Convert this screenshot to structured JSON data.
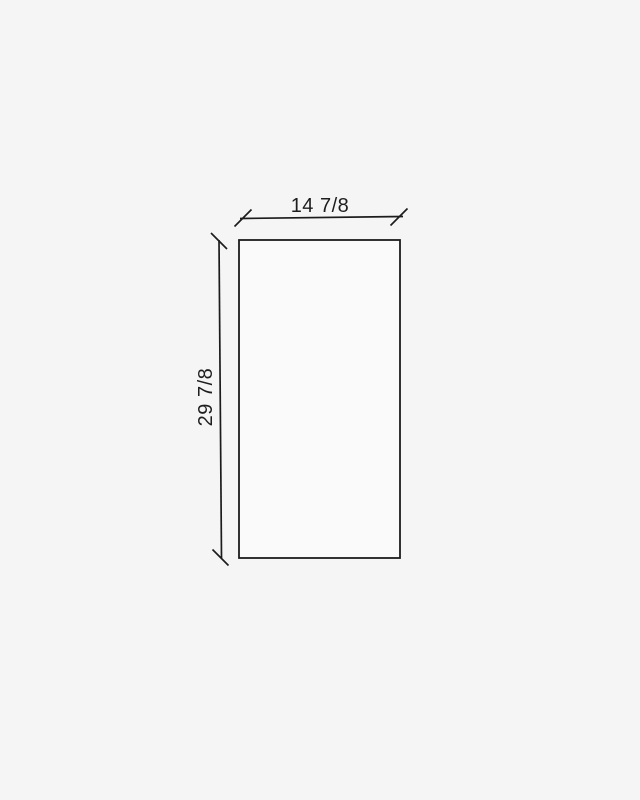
{
  "diagram": {
    "title": "panel-dimension-drawing",
    "width_label": "14 7/8",
    "height_label": "29 7/8"
  },
  "colors": {
    "background": "#f5f5f5",
    "panel_fill": "#fafafa",
    "line": "#1c1c1c",
    "text": "#1e1e1e"
  }
}
